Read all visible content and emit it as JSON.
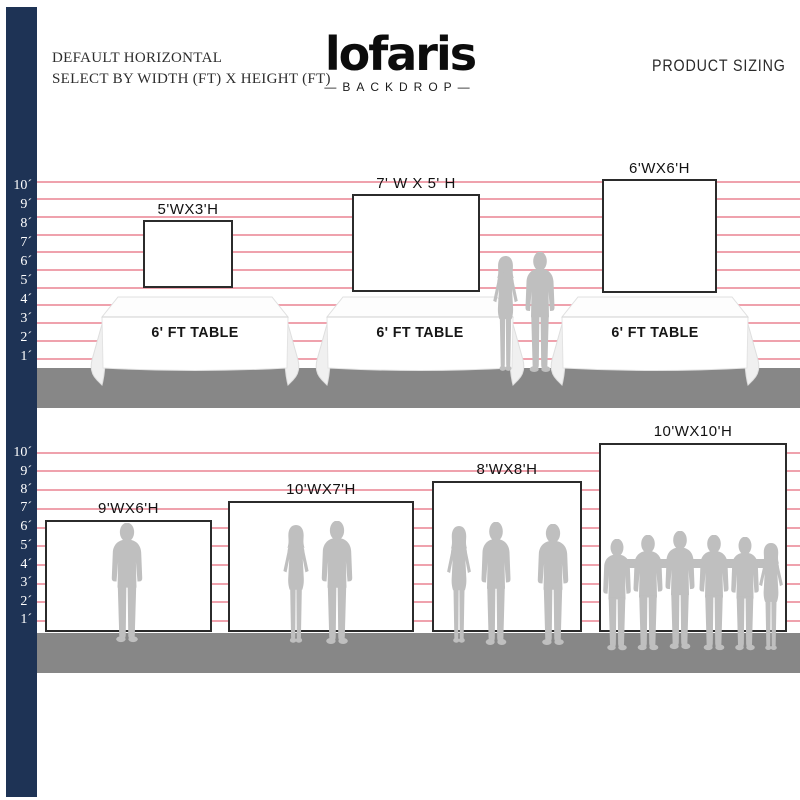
{
  "header": {
    "title_line1": "DEFAULT HORIZONTAL",
    "title_line2": "SELECT BY WIDTH (FT) X HEIGHT (FT)",
    "logo": "lofaris",
    "logo_sub": "—BACKDROP—",
    "product_sizing": "PRODUCT SIZING"
  },
  "ruler_labels": [
    "10´",
    "9´",
    "8´",
    "7´",
    "6´",
    "5´",
    "4´",
    "3´",
    "2´",
    "1´"
  ],
  "sections": {
    "top": {
      "backdrops": [
        {
          "label": "5'WX3'H",
          "width_ft": 5,
          "height_ft": 3
        },
        {
          "label": "7' W X 5' H",
          "width_ft": 7,
          "height_ft": 5
        },
        {
          "label": "6'WX6'H",
          "width_ft": 6,
          "height_ft": 6
        }
      ],
      "tables": [
        {
          "label": "6' FT TABLE"
        },
        {
          "label": "6' FT TABLE"
        },
        {
          "label": "6' FT TABLE"
        }
      ]
    },
    "bottom": {
      "backdrops": [
        {
          "label": "9'WX6'H",
          "width_ft": 9,
          "height_ft": 6
        },
        {
          "label": "10'WX7'H",
          "width_ft": 10,
          "height_ft": 7
        },
        {
          "label": "8'WX8'H",
          "width_ft": 8,
          "height_ft": 8
        },
        {
          "label": "10'WX10'H",
          "width_ft": 10,
          "height_ft": 10
        }
      ]
    }
  },
  "colors": {
    "navy": "#1e3355",
    "pink_line": "#efa2ad",
    "floor": "#878787",
    "silhouette": "#bfbfbf",
    "backdrop_border": "#2b2b2b"
  }
}
